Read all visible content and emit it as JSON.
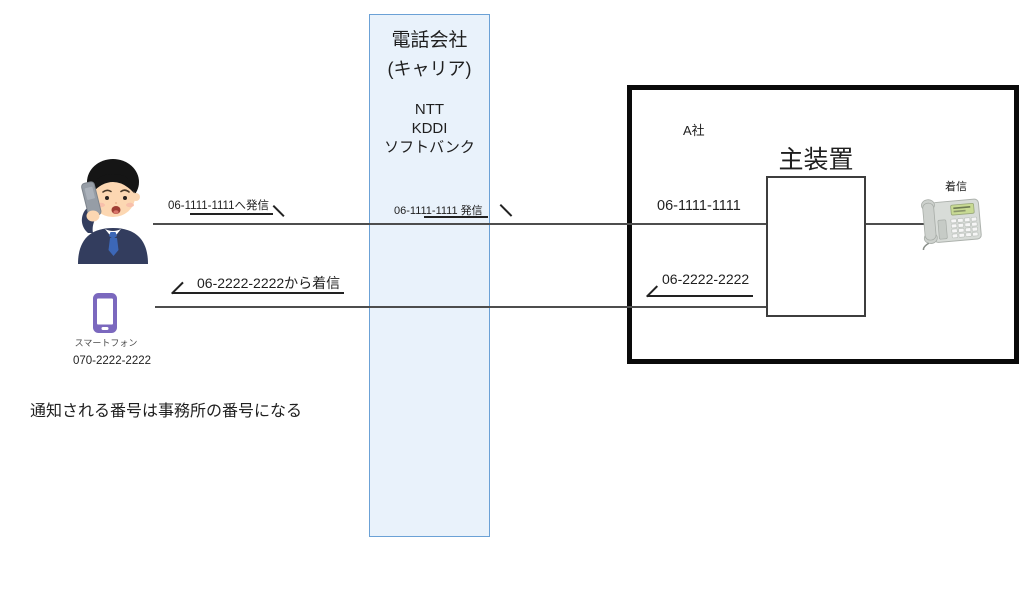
{
  "carrier": {
    "name_line1": "電話会社",
    "name_line2": "(キャリア)",
    "providers": [
      "NTT",
      "KDDI",
      "ソフトバンク"
    ]
  },
  "flows": {
    "caller_outbound_label": "06-1111-1111へ発信",
    "carrier_outbound_label": "06-1111-1111 発信",
    "caller_inbound_label": "06-2222-2222から着信",
    "office_inbound_number": "06-1111-1111",
    "office_outbound_number": "06-2222-2222"
  },
  "office": {
    "company_label": "A社",
    "device_label": "主装置",
    "incoming_label": "着信"
  },
  "smartphone": {
    "label": "スマートフォン",
    "number": "070-2222-2222"
  },
  "note": "通知される番号は事務所の番号になる",
  "icons": {
    "caller": "man-on-phone-icon",
    "smartphone": "smartphone-icon",
    "desk_phone": "desk-phone-icon"
  },
  "colors": {
    "carrier_fill": "#e9f2fb",
    "carrier_border": "#6ba1d6",
    "office_border": "#0a0a0a",
    "flow_line": "#4d4d4d",
    "arrow": "#222222",
    "smartphone_purple": "#7b68be",
    "text": "#1f1f1f"
  }
}
